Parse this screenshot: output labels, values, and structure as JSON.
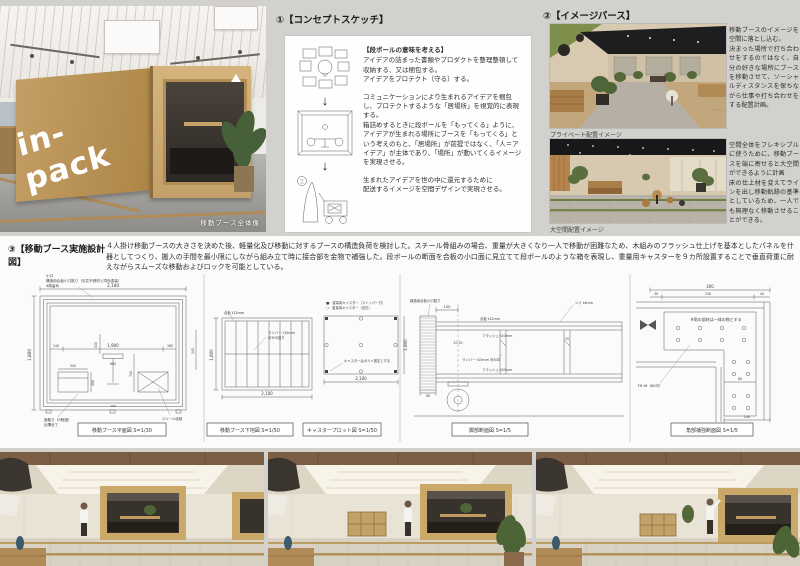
{
  "page": {
    "bg": "#d3d1ce"
  },
  "main_photo": {
    "logo": "in-pack",
    "caption": "移動ブース全体像"
  },
  "concept": {
    "heading": "①【コンセプトスケッチ】",
    "para1_title": "【段ボールの意味を考える】",
    "para1": "アイデアの詰まった書類やプロダクトを整理整頓して収納する、又は梱包する。\nアイデアをプロテクト（守る）する。",
    "para2": "コミュニケーションにより生まれるアイデアを梱包し、プロテクトするような「居場所」を視覚的に表現する。\n箱詰めするときに段ボールを「もってくる」ように、アイデアが生まれる場所にブースを「もってくる」という考えのもと、「居場所」が前提ではなく、「人＝アイデア」が主体であり、「場所」が動いてくるイメージを実現させる。",
    "para3": "生まれたアイデアを世の中に還元するために\n配送するイメージを空間デザインで実現させる。"
  },
  "perspective": {
    "heading": "②【イメージパース】",
    "caption1": "プライベート配置イメージ",
    "text1": "移動ブースのイメージを空間に落とし込む。\n決まった場所で打ち合わせをするのではなく、自分の好きな場所にブースを移動させて、ソーシャルディスタンスを保ちながら仕事や打ち合わせをする配置計画。",
    "caption2": "大空間配置イメージ",
    "text2": "空間全体をフレキシブルに使うために、移動ブースを端に寄せると大空間ができるように計画\n床の仕上材を変えてラインを出し移動軌跡の基準としているため、一人でも無理なく移動させることができる。"
  },
  "design": {
    "heading": "③【移動ブース実施設計図】",
    "description": "４人掛け移動ブースの大きさを決めた後、軽量化及び移動に対するブースの構造負荷を検討した。スチール骨組みの場合、重量が大きくなり一人で移動が困難なため、木組みのフラッシュ仕上げを基本としたパネルを什器としてつくり、搬入の手間を最小限にしながら組み立て時に接合部を金物で補強した。段ボールの断面を合板の小口面に見立てて段ボールのような箱を表現し、重量用キャスターを９カ所設置することで垂直荷重に耐えながらスムーズな移動およびロックを可能としている。"
  },
  "plan": {
    "label": "移動ブース平面図 S=1/30",
    "note_top1": "小口",
    "note_top2": "構造用合板小口貼り（天井不燃材と同色塗装）",
    "note_top3": "4周留め",
    "dim_w": "2,100",
    "dim_w_in": "1,900",
    "dim_h": "1,800",
    "dim_140": "140",
    "dim_180": "180",
    "dim_160": "160",
    "dim_145": "145",
    "dim_500": "500",
    "dim_400": "400",
    "dim_520": "520",
    "dim_600": "600",
    "dim_720": "720",
    "note_bl1": "面取り（R程度）",
    "note_bl2": "出隅全て",
    "note_br": "スツール収納"
  },
  "substrate": {
    "label": "移動ブース下地図 S=1/50",
    "note_gohan": "合板 t12mm",
    "note1": "ランバー t15mm",
    "note2": "＠300割り",
    "dim_w": "2,100",
    "dim_h": "1,800"
  },
  "caster": {
    "label": "キャスタープロット図 S=1/50",
    "legend1": "■：重量用キャスター（ストッパー付）",
    "legend2": "○：重量用キャスター（自在）",
    "note": "キャスターはボルト固定とする",
    "dim_w": "2,100",
    "dim_h": "1,800"
  },
  "leg": {
    "label": "脚部断面図 S=1/5",
    "dim_100": "100",
    "dim_40": "40",
    "dim_2020": "20 20",
    "dim_15": "15",
    "note_edge": "構造用合板小口貼り",
    "note_shina": "シナ t4mm",
    "note_gohan": "合板 t12mm",
    "note_flush1": "フラッシュ t20mm",
    "note_lumber": "ランバー t15mm ＠300",
    "note_flush2": "フラッシュ t20mm"
  },
  "corner": {
    "label": "角部補強断面図 S=1/5",
    "dim_300": "300",
    "dim_30": "30",
    "dim_230": "230",
    "dim_40": "40",
    "dim_60": "60",
    "dim_140": "140",
    "note": "※角の部材は一体の物とする",
    "fb": "FB t6（60巾）"
  }
}
